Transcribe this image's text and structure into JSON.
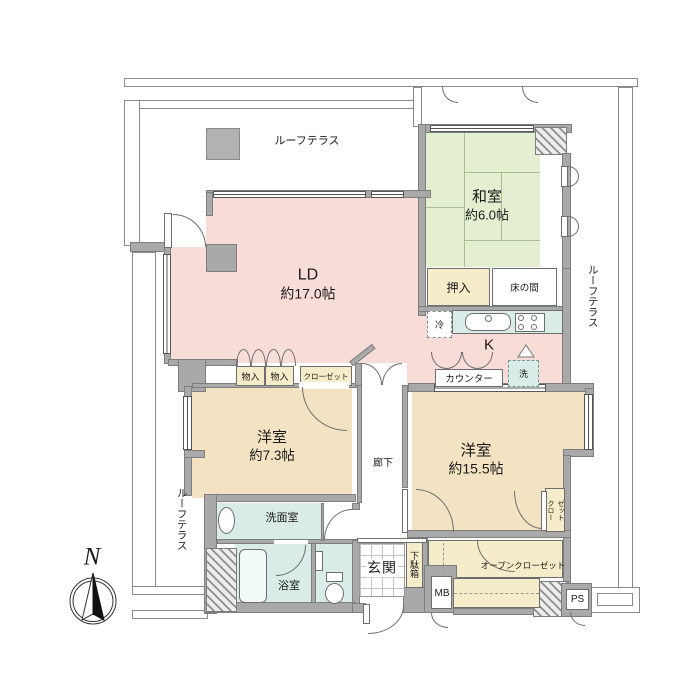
{
  "floorplan": {
    "compass_north": "N",
    "terrace": {
      "top": "ルーフテラス",
      "right": "ルーフテラス",
      "left": "ルーフテラス"
    },
    "rooms": {
      "living_dining": {
        "name": "LD",
        "size": "約17.0帖"
      },
      "kitchen": {
        "name": "K"
      },
      "japanese_room": {
        "name": "和室",
        "size": "約6.0帖"
      },
      "bedroom_73": {
        "name": "洋室",
        "size": "約7.3帖"
      },
      "bedroom_155": {
        "name": "洋室",
        "size": "約15.5帖"
      },
      "hallway": "廊下",
      "entrance": "玄関",
      "bathroom": "浴室",
      "washroom": "洗面室"
    },
    "storage": {
      "oshiire": "押入",
      "tokonoma": "床の間",
      "storage1": "物入",
      "storage2": "物入",
      "closet": "クローゼット",
      "closet_vertical": {
        "col1": "クロー",
        "col2": "ゼット"
      },
      "open_closet": "オープンクローゼット",
      "shoe_box": "下駄箱"
    },
    "kitchen_items": {
      "refrigerator": "冷",
      "washer": "洗",
      "counter": "カウンター"
    },
    "utility": {
      "meter_box": "MB",
      "pipe_space": "PS"
    },
    "colors": {
      "ld_pink": "#f8dcd8",
      "tatami_green": "#e4efd2",
      "bedroom_beige": "#f3e3c2",
      "wet_area_teal": "#d9ece8",
      "storage_cream": "#f5ecc9",
      "wall_gray": "#a9a9a9"
    }
  }
}
